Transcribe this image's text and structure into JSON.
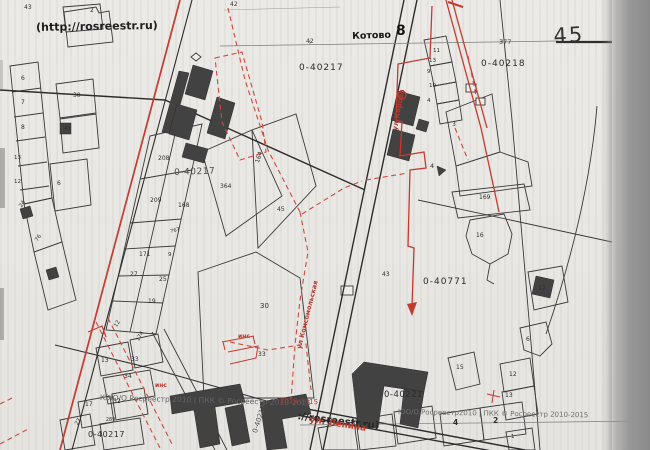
{
  "colors": {
    "paper": "#eae8e4",
    "ink": "#2e2e2e",
    "red_annotation": "#c23b30",
    "red_dashed": "#cf4a3c",
    "building_fill": "#424242",
    "watermark_gray": "#636363",
    "scanner_band": "#969696"
  },
  "map": {
    "source_url_label": "(http://rosreestr.ru)",
    "sheet_number": "45",
    "settlement": {
      "name": "Котово",
      "index": "8"
    },
    "cadastral_quarters": [
      "0-40217",
      "0-40218",
      "0-40771",
      "0-40221"
    ],
    "streets": [
      "ул Кирова",
      "ул Комсомольская",
      "ул. Ленина"
    ],
    "watermarks": {
      "left": "КЭЮ/О Росреестр 2010 | ПКК © Росреестр 2010-2015",
      "right": "ЮО/О Росреестр2010 | ПКК © Росреестр 2010-2015",
      "url_bottom": "://rosreestr.ru)"
    },
    "labels": [
      {
        "n": "url-watermark-top",
        "t": "(http://rosreestr.ru)",
        "x": 36,
        "y": 22,
        "s": 11,
        "w": 600,
        "c": "#1f1f1f",
        "r": -1
      },
      {
        "n": "settlement-name",
        "t": "Котово",
        "x": 352,
        "y": 32,
        "s": 9.5,
        "w": 700,
        "c": "#161616",
        "r": -2
      },
      {
        "n": "settlement-index",
        "t": "8",
        "x": 396,
        "y": 24,
        "s": 14,
        "w": 700,
        "c": "#161616"
      },
      {
        "n": "sheet-number",
        "t": "45",
        "x": 553,
        "y": 26,
        "s": 21,
        "w": 500,
        "c": "#333333",
        "r": -3,
        "ls": 2
      },
      {
        "n": "distance-label",
        "t": "377",
        "x": 499,
        "y": 39,
        "s": 6.5,
        "c": "#3a3a3a"
      },
      {
        "n": "distance-label",
        "t": "42",
        "x": 230,
        "y": 2,
        "s": 6,
        "c": "#3a3a3a"
      },
      {
        "n": "distance-label",
        "t": "42",
        "x": 306,
        "y": 39,
        "s": 6,
        "c": "#3a3a3a"
      },
      {
        "n": "quarter-label",
        "t": "0-40217",
        "x": 299,
        "y": 64,
        "s": 9,
        "ls": 1,
        "c": "#2a2a2a"
      },
      {
        "n": "quarter-label",
        "t": "0-40218",
        "x": 481,
        "y": 60,
        "s": 9,
        "ls": 1,
        "c": "#2a2a2a"
      },
      {
        "n": "quarter-label-stamp",
        "t": "0-40217",
        "x": 174,
        "y": 169,
        "s": 9,
        "ls": 0.5,
        "c": "#4a4a4a",
        "r": -2
      },
      {
        "n": "quarter-label",
        "t": "0-40771",
        "x": 423,
        "y": 278,
        "s": 9,
        "ls": 1,
        "c": "#2a2a2a"
      },
      {
        "n": "quarter-label",
        "t": "0-40221",
        "x": 384,
        "y": 391,
        "s": 8.5,
        "ls": 0.5,
        "c": "#2a2a2a"
      },
      {
        "n": "quarter-label",
        "t": "0-40217",
        "x": 88,
        "y": 431,
        "s": 8,
        "ls": 0.5,
        "c": "#2a2a2a"
      },
      {
        "n": "quarter-label",
        "t": "0-40217",
        "x": 252,
        "y": 432,
        "s": 7,
        "c": "#555555",
        "r": -72
      },
      {
        "n": "watermark-left",
        "t": "КЭЮ/О Росреестр 2010 | ПКК © Росреестр 2010-2015",
        "x": 100,
        "y": 394,
        "s": 7.5,
        "c": "#636363",
        "r": 1.5
      },
      {
        "n": "watermark-right",
        "t": "ЮО/О Росреестр2010 | ПКК © Росреестр 2010-2015",
        "x": 398,
        "y": 409,
        "s": 7,
        "c": "#6e6e6e",
        "r": 1
      },
      {
        "n": "watermark-tail",
        "t": "2010-2015",
        "x": 280,
        "y": 398,
        "s": 7,
        "c": "#b23a30",
        "r": 2
      },
      {
        "n": "url-watermark-bottom",
        "t": "://rosreestr.ru)",
        "x": 298,
        "y": 412,
        "s": 10,
        "w": 700,
        "c": "#262626",
        "r": 7
      },
      {
        "n": "street-name",
        "t": "ул Кирова",
        "x": 392,
        "y": 130,
        "s": 7,
        "c": "#b23a30",
        "r": -80,
        "w": 600
      },
      {
        "n": "street-name",
        "t": "ул Комсомольская",
        "x": 296,
        "y": 348,
        "s": 6.5,
        "c": "#b23a30",
        "r": -76,
        "w": 600
      },
      {
        "n": "street-name",
        "t": "ул. Ленина",
        "x": 310,
        "y": 416,
        "s": 9,
        "c": "#c23b30",
        "r": 9,
        "w": 600
      },
      {
        "n": "annotation",
        "t": "инс",
        "x": 238,
        "y": 334,
        "s": 6,
        "c": "#b23a30",
        "w": 600
      },
      {
        "n": "annotation",
        "t": "инс",
        "x": 155,
        "y": 383,
        "s": 6,
        "c": "#b23a30",
        "w": 600
      },
      {
        "n": "parcel-number",
        "t": "43",
        "x": 24,
        "y": 5,
        "s": 6
      },
      {
        "n": "parcel-number",
        "t": "2",
        "x": 90,
        "y": 8,
        "s": 6
      },
      {
        "n": "parcel-number",
        "t": "6",
        "x": 21,
        "y": 76,
        "s": 6
      },
      {
        "n": "parcel-number",
        "t": "7",
        "x": 21,
        "y": 100,
        "s": 6
      },
      {
        "n": "parcel-number",
        "t": "8",
        "x": 21,
        "y": 125,
        "s": 6
      },
      {
        "n": "parcel-number",
        "t": "13",
        "x": 14,
        "y": 156,
        "s": 5.5
      },
      {
        "n": "parcel-number",
        "t": "12",
        "x": 14,
        "y": 180,
        "s": 5.5
      },
      {
        "n": "parcel-number",
        "t": "24",
        "x": 19,
        "y": 206,
        "s": 5.5,
        "r": -55
      },
      {
        "n": "parcel-number",
        "t": "76",
        "x": 35,
        "y": 240,
        "s": 5.5,
        "r": -55
      },
      {
        "n": "parcel-number",
        "t": "30",
        "x": 73,
        "y": 93,
        "s": 6
      },
      {
        "n": "parcel-number",
        "t": "40",
        "x": 64,
        "y": 127,
        "s": 5
      },
      {
        "n": "parcel-number",
        "t": "6",
        "x": 57,
        "y": 181,
        "s": 6
      },
      {
        "n": "parcel-number",
        "t": "208",
        "x": 158,
        "y": 156,
        "s": 6
      },
      {
        "n": "parcel-number",
        "t": "209",
        "x": 150,
        "y": 198,
        "s": 6
      },
      {
        "n": "parcel-number",
        "t": "168",
        "x": 178,
        "y": 203,
        "s": 6
      },
      {
        "n": "parcel-number",
        "t": "164",
        "x": 255,
        "y": 162,
        "s": 6,
        "r": -72
      },
      {
        "n": "parcel-number",
        "t": "364",
        "x": 220,
        "y": 184,
        "s": 6
      },
      {
        "n": "parcel-number",
        "t": "45",
        "x": 277,
        "y": 207,
        "s": 6
      },
      {
        "n": "parcel-number",
        "t": "171",
        "x": 139,
        "y": 252,
        "s": 6
      },
      {
        "n": "parcel-number",
        "t": "27",
        "x": 130,
        "y": 272,
        "s": 6
      },
      {
        "n": "parcel-number",
        "t": "25",
        "x": 159,
        "y": 277,
        "s": 6
      },
      {
        "n": "parcel-number",
        "t": "19",
        "x": 148,
        "y": 299,
        "s": 6
      },
      {
        "n": "parcel-number",
        "t": "9",
        "x": 168,
        "y": 253,
        "s": 5.5
      },
      {
        "n": "parcel-number",
        "t": "767",
        "x": 170,
        "y": 230,
        "s": 5,
        "r": -15
      },
      {
        "n": "parcel-number",
        "t": "12",
        "x": 114,
        "y": 326,
        "s": 5.5,
        "r": -60
      },
      {
        "n": "parcel-number",
        "t": "174",
        "x": 136,
        "y": 340,
        "s": 5.5,
        "r": -60
      },
      {
        "n": "parcel-number",
        "t": "30",
        "x": 260,
        "y": 303,
        "s": 7
      },
      {
        "n": "parcel-number",
        "t": "33",
        "x": 258,
        "y": 352,
        "s": 6
      },
      {
        "n": "parcel-number",
        "t": "43",
        "x": 382,
        "y": 272,
        "s": 6
      },
      {
        "n": "parcel-number",
        "t": "13",
        "x": 101,
        "y": 358,
        "s": 6
      },
      {
        "n": "parcel-number",
        "t": "33",
        "x": 131,
        "y": 357,
        "s": 6
      },
      {
        "n": "parcel-number",
        "t": "34",
        "x": 124,
        "y": 374,
        "s": 6
      },
      {
        "n": "parcel-number",
        "t": "17",
        "x": 85,
        "y": 402,
        "s": 6
      },
      {
        "n": "parcel-number",
        "t": "32",
        "x": 113,
        "y": 399,
        "s": 6
      },
      {
        "n": "parcel-number",
        "t": "27",
        "x": 75,
        "y": 424,
        "s": 5.5,
        "r": -60
      },
      {
        "n": "parcel-number",
        "t": "289",
        "x": 106,
        "y": 419,
        "s": 4.8
      },
      {
        "n": "parcel-number",
        "t": "11",
        "x": 433,
        "y": 49,
        "s": 5.5
      },
      {
        "n": "parcel-number",
        "t": "13",
        "x": 429,
        "y": 59,
        "s": 5.5
      },
      {
        "n": "parcel-number",
        "t": "9",
        "x": 427,
        "y": 70,
        "s": 5.5
      },
      {
        "n": "parcel-number",
        "t": "10",
        "x": 429,
        "y": 84,
        "s": 5.5
      },
      {
        "n": "parcel-number",
        "t": "4",
        "x": 427,
        "y": 99,
        "s": 5.5
      },
      {
        "n": "parcel-number",
        "t": "3",
        "x": 452,
        "y": 122,
        "s": 6
      },
      {
        "n": "parcel-number",
        "t": "4",
        "x": 430,
        "y": 163,
        "s": 6.5
      },
      {
        "n": "parcel-number",
        "t": "169",
        "x": 479,
        "y": 195,
        "s": 6
      },
      {
        "n": "parcel-number",
        "t": "16",
        "x": 476,
        "y": 233,
        "s": 6
      },
      {
        "n": "parcel-number",
        "t": "17",
        "x": 538,
        "y": 286,
        "s": 6
      },
      {
        "n": "parcel-number",
        "t": "6",
        "x": 526,
        "y": 337,
        "s": 6
      },
      {
        "n": "parcel-number",
        "t": "15",
        "x": 456,
        "y": 365,
        "s": 6
      },
      {
        "n": "parcel-number",
        "t": "12",
        "x": 509,
        "y": 372,
        "s": 6
      },
      {
        "n": "parcel-number",
        "t": "13",
        "x": 505,
        "y": 393,
        "s": 6
      },
      {
        "n": "section-number",
        "t": "4",
        "x": 453,
        "y": 419,
        "s": 7.5,
        "w": 600
      },
      {
        "n": "section-number",
        "t": "2",
        "x": 493,
        "y": 417,
        "s": 7.5,
        "w": 600
      },
      {
        "n": "parcel-number",
        "t": "1",
        "x": 511,
        "y": 435,
        "s": 5.5
      }
    ]
  }
}
